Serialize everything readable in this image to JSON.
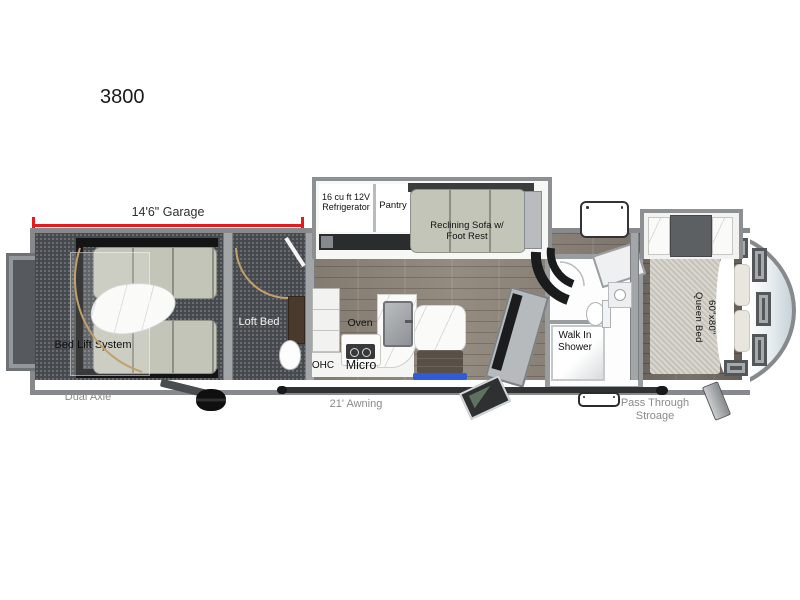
{
  "page": {
    "background": "#ffffff"
  },
  "floorplan": {
    "model_number": "3800",
    "labels": {
      "garage_dimension": "14'6\" Garage",
      "refrigerator": "16 cu ft 12V\nRefrigerator",
      "pantry": "Pantry",
      "reclining_sofa": "Reclining Sofa w/\nFoot Rest",
      "bed_lift_system": "Bed Lift System",
      "loft_bed": "Loft Bed",
      "oven": "Oven",
      "ohc": "OHC",
      "micro": "Micro",
      "walk_in_shower": "Walk In\nShower",
      "queen_bed": "60\"x80\"\nQueen Bed",
      "dual_axle": "Dual Axle",
      "awning": "21' Awning",
      "pass_through_storage": "Pass Through\nStroage"
    },
    "colors": {
      "dimension_line": "#e8191c",
      "exterior_label_text": "#8a8a8a",
      "interior_label_text": "#111111",
      "wall_gray": "#87898c",
      "garage_floor": "#45484c",
      "wood_floor": "#8a8076",
      "sofa_fabric": "#c3c5b8",
      "entry_mat_blue": "#2e5cd6",
      "bed_lift_frame": "#141414"
    }
  }
}
